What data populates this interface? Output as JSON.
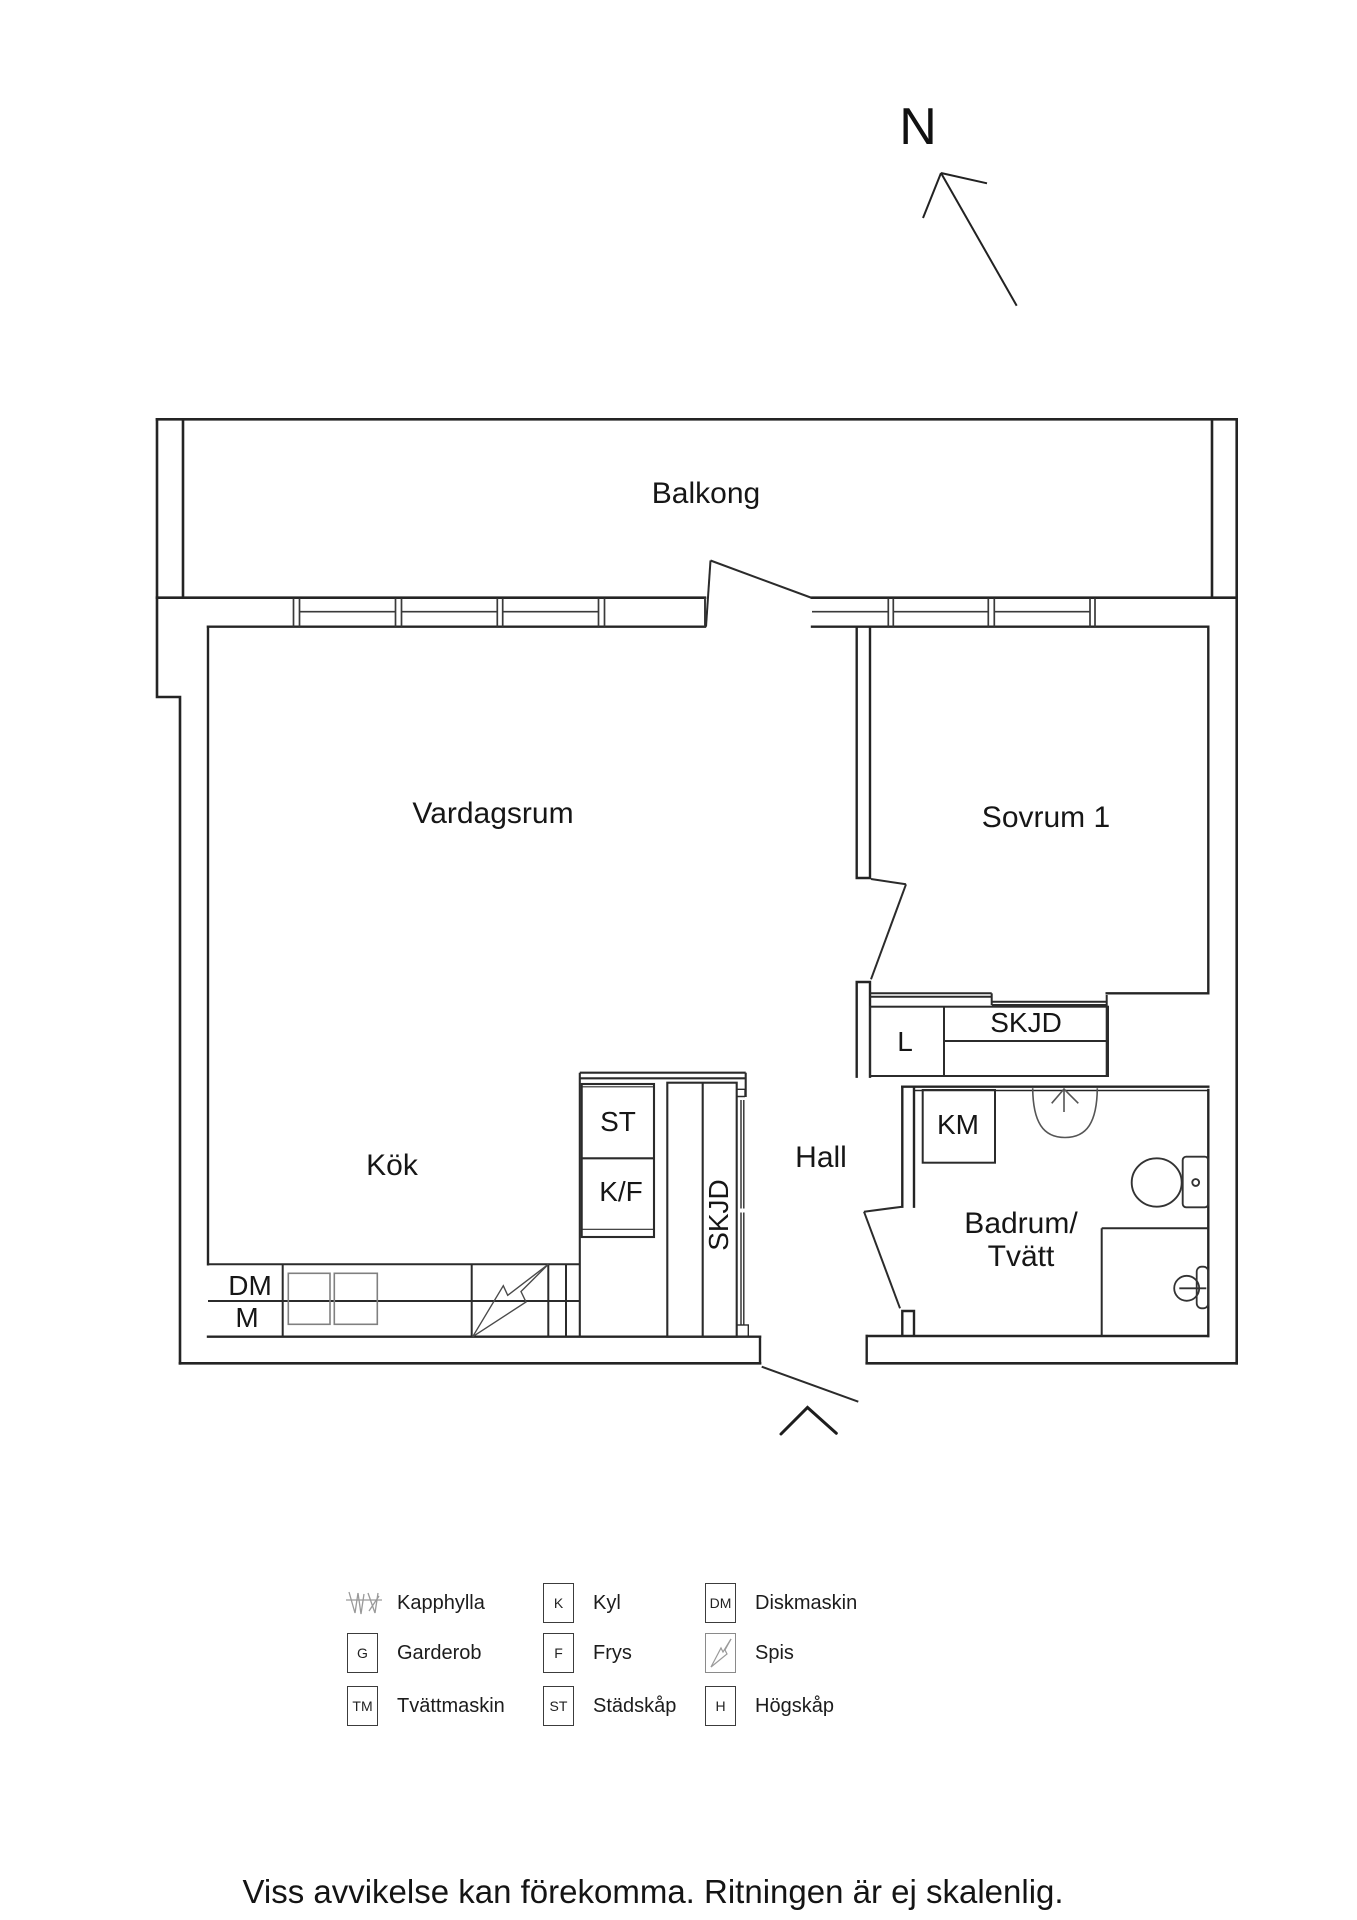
{
  "compass": {
    "north_label": "N"
  },
  "rooms": {
    "balkong": "Balkong",
    "vardagsrum": "Vardagsrum",
    "sovrum": "Sovrum 1",
    "kok": "Kök",
    "hall": "Hall",
    "badrum_line1": "Badrum/",
    "badrum_line2": "Tvätt"
  },
  "fixtures": {
    "skjd_bedroom_closet": "SKJD",
    "skjd_hall_closet": "SKJD",
    "linen_closet": "L",
    "washer_combo": "KM",
    "cleaning_cabinet": "ST",
    "fridge_freezer": "K/F",
    "dishwasher": "DM",
    "micro": "M"
  },
  "legend": {
    "items": [
      {
        "symbol": "",
        "label": "Kapphylla"
      },
      {
        "symbol": "K",
        "label": "Kyl"
      },
      {
        "symbol": "DM",
        "label": "Diskmaskin"
      },
      {
        "symbol": "G",
        "label": "Garderob"
      },
      {
        "symbol": "F",
        "label": "Frys"
      },
      {
        "symbol": "",
        "label": "Spis"
      },
      {
        "symbol": "TM",
        "label": "Tvättmaskin"
      },
      {
        "symbol": "ST",
        "label": "Städskåp"
      },
      {
        "symbol": "H",
        "label": "Högskåp"
      }
    ]
  },
  "footer": {
    "disclaimer": "Viss avvikelse kan förekomma. Ritningen är ej skalenlig."
  },
  "colors": {
    "wall": "#242424",
    "thin_line": "#3a3a3a",
    "gray_line": "#808080",
    "text": "#161616"
  }
}
